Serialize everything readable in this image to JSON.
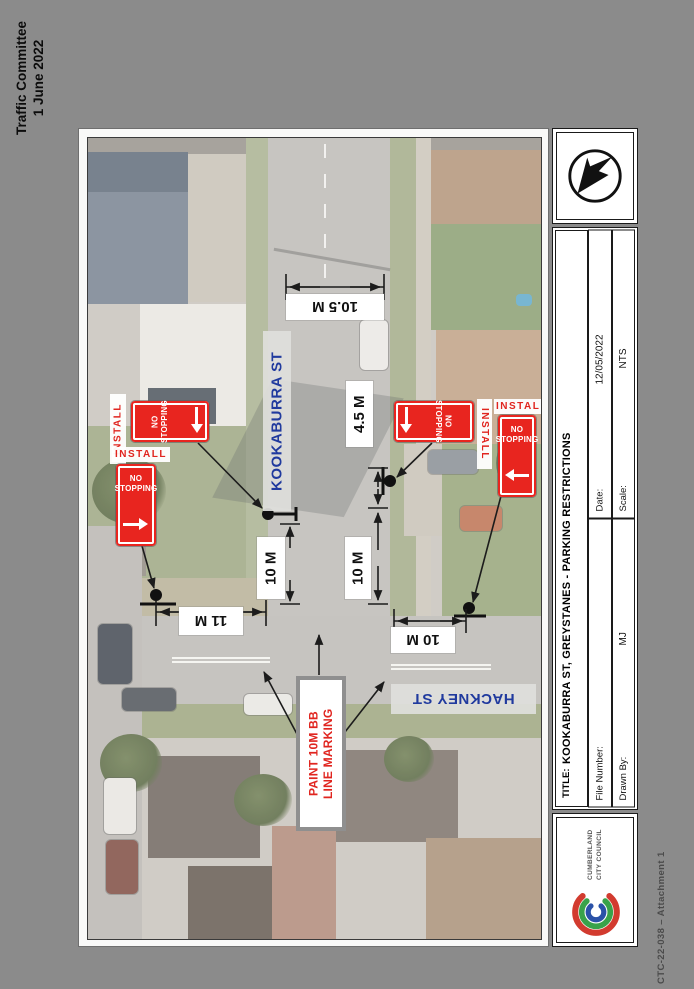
{
  "page": {
    "corner_note": {
      "line1": "Traffic Committee",
      "line2": "1 June 2022"
    },
    "footer_note": "CTC-22-038 – Attachment 1"
  },
  "map": {
    "street_labels": {
      "kookaburra": "KOOKABURRA ST",
      "hackney": "HACKNEY ST"
    },
    "install_label": "INSTALL",
    "sign": {
      "line1": "NO",
      "line2": "STOPPING"
    },
    "paint_note": {
      "line1": "PAINT 10M BB",
      "line2": "LINE MARKING"
    },
    "dimensions": {
      "road_width_top": "10.5 M",
      "east_offset": "4.5 M",
      "west_no_stopping": "10 M",
      "east_no_stopping": "10 M",
      "hackney_west": "11 M",
      "hackney_east": "10 M"
    }
  },
  "title_block": {
    "title_label": "TITLE:",
    "title": "KOOKABURRA ST, GREYSTANES - PARKING RESTRICTIONS",
    "date_label": "Date:",
    "date_value": "12/05/2022",
    "scale_label": "Scale:",
    "scale_value": "NTS",
    "file_number_label": "File Number:",
    "file_number_value": "",
    "drawn_by_label": "Drawn By:",
    "drawn_by_value": "MJ",
    "council": {
      "name_line1": "CUMBERLAND",
      "name_line2": "CITY COUNCIL"
    }
  },
  "colors": {
    "sign_red": "#E8251F",
    "street_label_blue": "#203A9E",
    "paint_note_red": "#E0251F",
    "council_red": "#D23B2F",
    "council_green": "#39A24A",
    "council_blue": "#2B52A8",
    "page_background": "#8B8B8B"
  }
}
